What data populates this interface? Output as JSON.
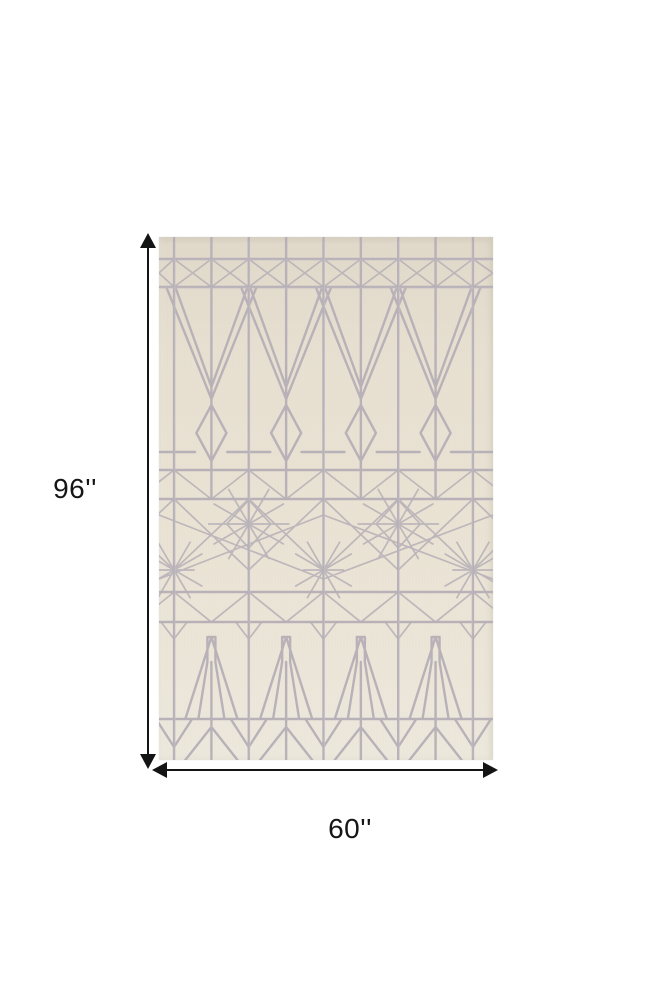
{
  "figure": {
    "description": "Ivory and silver-gray geometric art deco area rug shown flat with dimension arrows",
    "height_label": "96''",
    "width_label": "60''"
  },
  "icons": {
    "height_arrowheads": [
      "arrow-up-icon",
      "arrow-down-icon"
    ],
    "width_arrowheads": [
      "arrow-left-icon",
      "arrow-right-icon"
    ]
  },
  "colors": {
    "background": "#ffffff",
    "rug_base": "#e9e2d3",
    "rug_base_light": "#ece7db",
    "pattern_line": "#b5afb6",
    "dimension_line": "#141414"
  }
}
